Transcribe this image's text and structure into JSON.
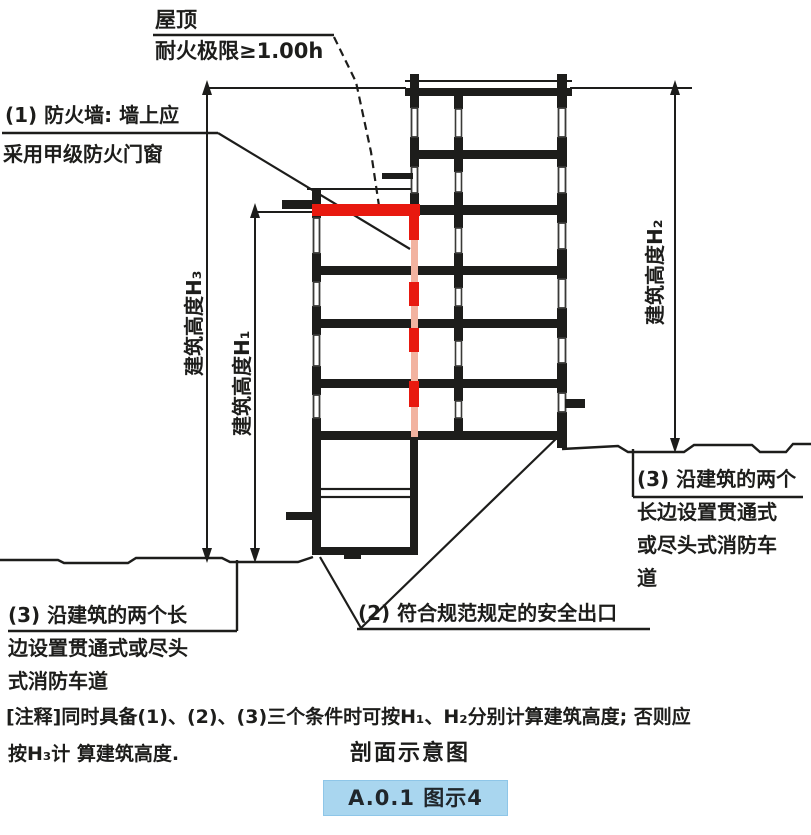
{
  "annotations": {
    "roof": {
      "line1": "屋顶",
      "line2": "耐火极限≥1.00h"
    },
    "firewall": {
      "line1": "(1) 防火墙: 墙上应",
      "line2": "采用甲级防火门窗"
    },
    "exit": {
      "text": "(2) 符合规范规定的安全出口"
    },
    "road_left": {
      "line1": "(3) 沿建筑的两个长",
      "line2": "边设置贯通式或尽头",
      "line3": "式消防车道"
    },
    "road_right": {
      "line1": "(3) 沿建筑的两个",
      "line2": "长边设置贯通式",
      "line3": "或尽头式消防车",
      "line4": "道"
    }
  },
  "dimensions": {
    "h3": "建筑高度H₃",
    "h1": "建筑高度H₁",
    "h2": "建筑高度H₂"
  },
  "note": {
    "line1": "[注释]同时具备(1)、(2)、(3)三个条件时可按H₁、H₂分别计算建筑高度; 否则应",
    "line2": "按H₃计 算建筑高度."
  },
  "caption": "剖面示意图",
  "badge": {
    "label": "A.0.1 图示4"
  },
  "legend_colors": {
    "firewall_red": "#e8190f",
    "firewall_red_pale": "#f2b3a0",
    "line_black": "#1d1d1b",
    "badge_bg": "#a9d6ef",
    "badge_text": "#20262b"
  }
}
